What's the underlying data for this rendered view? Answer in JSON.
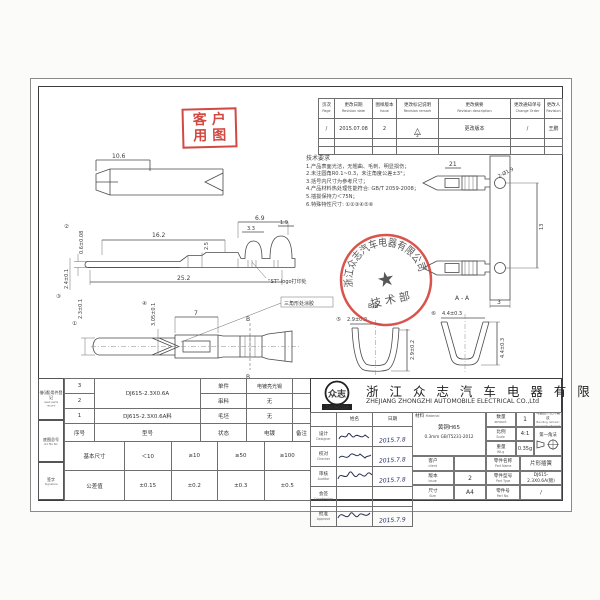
{
  "stamps": {
    "customer_line1": "客户",
    "customer_line2": "用图",
    "seal_arc": "浙江众志汽车电器有限公司",
    "seal_dept": "技 术 部"
  },
  "revision_table": {
    "headers": [
      {
        "cn": "页次",
        "en": "Page"
      },
      {
        "cn": "更改日期",
        "en": "Revision date"
      },
      {
        "cn": "图样版本",
        "en": "Issue"
      },
      {
        "cn": "更改标记说明",
        "en": "Revision remark"
      },
      {
        "cn": "更改摘要",
        "en": "Revision description"
      },
      {
        "cn": "更改通知单号",
        "en": "Change Order"
      },
      {
        "cn": "更改人",
        "en": "Revision"
      }
    ],
    "row1": {
      "page": "/",
      "date": "2015.07.08",
      "issue": "2",
      "remark": "△",
      "remark_no": "2",
      "description": "更改版本",
      "order": "/",
      "by": "王鹏"
    }
  },
  "notes": {
    "title": "技术要求",
    "lines": [
      "1.产品表面光洁，无翘曲、毛刺、明显损伤；",
      "2.未注圆角R0.1~0.3，未注角度公差±3°；",
      "3.括号内尺寸为参考尺寸；",
      "4.产品材料热处理性能符合: GB/T 2059-2008；",
      "5.插拔保持力＜75N；",
      "6.特殊特性尺寸: ①②③④⑤⑥"
    ]
  },
  "dims": {
    "blade": {
      "w": "10.6"
    },
    "side": {
      "top_len": "16.2",
      "front_h": "2.5",
      "crimp_span": "6.9",
      "wire_crimp": "3.3",
      "tab": "1.9",
      "total_len": "25.2",
      "pin_th": "0.6±0.08",
      "pin_th_mark": "②",
      "pin_w": "2.4±0.1",
      "pin_w_mark": "③",
      "label_logo": "“ST” logo打印处"
    },
    "top": {
      "pin_w": "2.3±0.1",
      "pin_w_mark": "①",
      "neck": "3.05±0.1",
      "neck_mark": "④",
      "window": "7",
      "section": "B",
      "label_glue": "三角形处涂胶"
    },
    "carrier": {
      "pitch": "21",
      "holes": "2-Ø1.9",
      "span": "13",
      "strip_w": "3"
    },
    "bb": {
      "title": "B-B",
      "w": "2.9±0.2",
      "w_mark": "⑤",
      "h": "2.9±0.2"
    },
    "aa": {
      "title": "A-A",
      "w": "4.4±0.3",
      "w_mark": "⑥",
      "h": "4.4±0.3"
    }
  },
  "margin_blocks": [
    {
      "cn": "借(通)用件登记",
      "en": "used parts record"
    },
    {
      "cn": "底图总号",
      "en": "old file No."
    },
    {
      "cn": "签字",
      "en": "Signature"
    }
  ],
  "parts_table": {
    "headers": {
      "no": "序号",
      "type": "型号",
      "state": "状态",
      "plating": "电镀",
      "note": "备注"
    },
    "type_32": "DJ615-2.3X0.6A",
    "row3": {
      "no": "3",
      "state": "单件",
      "plating": "电镀亮光锡"
    },
    "row2": {
      "no": "2",
      "state": "串料",
      "plating": "无"
    },
    "row1": {
      "no": "1",
      "type": "DJ615-2.3X0.6A料",
      "state": "毛坯",
      "plating": "无"
    }
  },
  "tolerance_table": {
    "label1": "基本尺寸",
    "v1": [
      "＜10",
      "≥10",
      "≥50",
      "≥100"
    ],
    "label2": "公差值",
    "v2": [
      "±0.15",
      "±0.2",
      "±0.3",
      "±0.5"
    ]
  },
  "title_block": {
    "logo_cn": "众志",
    "logo_en": "ZHONGZHI",
    "company_cn": "浙 江 众 志 汽 车 电 器 有 限 公 司",
    "company_en": "ZHEJIANG ZHONGZHI AUTOMOBILE ELECTRICAL CO.,Ltd",
    "col_name": "姓名",
    "col_date": "日期",
    "sign_rows": [
      {
        "cn": "设计",
        "en": "Designer",
        "date": "2015.7.8"
      },
      {
        "cn": "校对",
        "en": "Checker",
        "date": "2015.7.8"
      },
      {
        "cn": "审核",
        "en": "Auditor",
        "date": "2015.7.8"
      },
      {
        "cn": "会签",
        "en": "Countersign",
        "date": ""
      },
      {
        "cn": "批准",
        "en": "Approve",
        "date": "2015.7.9"
      }
    ],
    "material_label_cn": "材料",
    "material_label_en": "Material",
    "material_line1": "黄铜H65",
    "material_line2": "0.3mm GB/T5231-2012",
    "client_cn": "客户",
    "client_en": "client",
    "client_value": "",
    "issue_cn": "版本",
    "issue_en": "Issue",
    "issue_value": "2",
    "size_cn": "尺寸",
    "size_en": "Size",
    "size_value": "A4",
    "amount_cn": "数量",
    "amount_en": "amount",
    "amount_value": "1",
    "scale_cn": "比例",
    "scale_en": "Scale",
    "scale_value": "4:1",
    "weight_cn": "重量",
    "weight_en": "Wt.g",
    "weight_value": "0.35g",
    "bend_note_cn": "弯曲处不允许裂纹",
    "bend_note_en": "Bending remark: no crack allowed",
    "projection": "第一角法",
    "part_name_cn": "零件名称",
    "part_name_en": "Part Name",
    "part_name_value": "片形插簧",
    "part_type_cn": "零件型号",
    "part_type_en": "Part Type",
    "part_type_value": "DJ615-2.3X0.6A(镀)",
    "part_no_cn": "零件号",
    "part_no_en": "Part No.",
    "part_no_value": "/"
  }
}
